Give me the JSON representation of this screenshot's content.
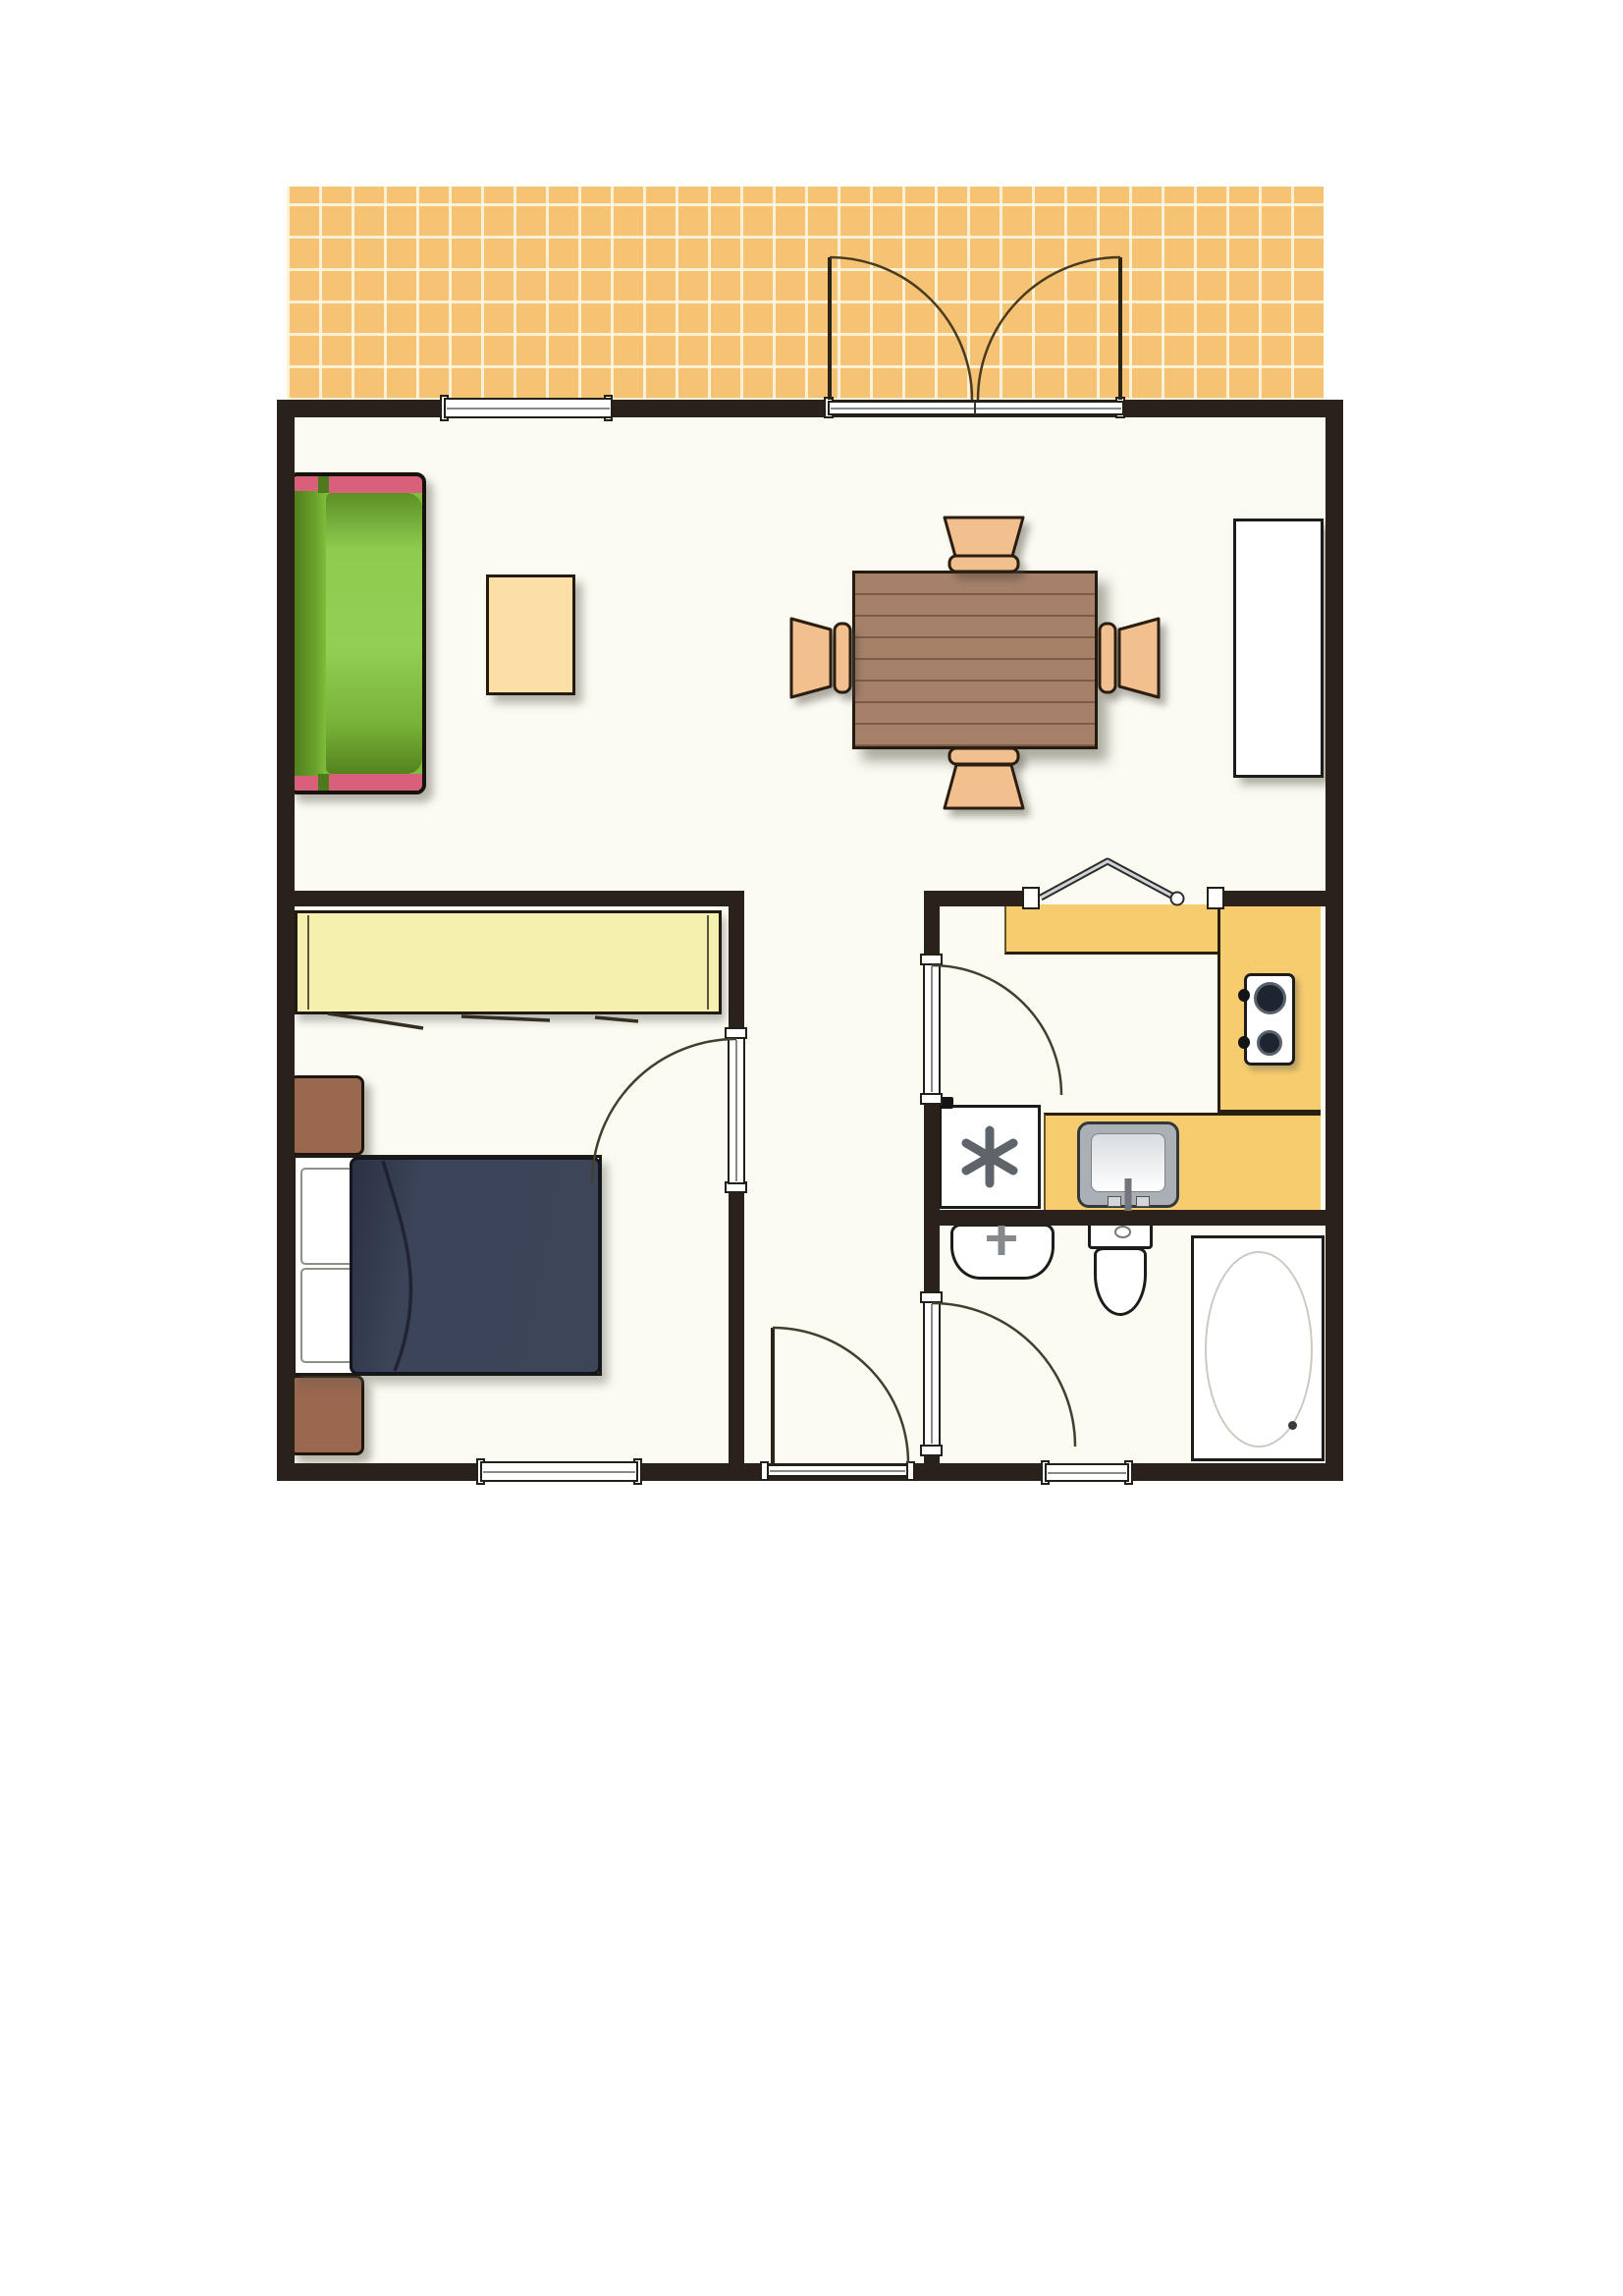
{
  "meta": {
    "title": "One-bedroom apartment floor plan",
    "type": "floor-plan",
    "visible_text": "none"
  },
  "palette": {
    "wall": "#29211a",
    "floor": "#fbfbf2",
    "outline": "#1c1c1c",
    "terrace_tile": "#f5c373",
    "terrace_grout": "#fff4dc",
    "sofa_green": "#7fbe3a",
    "sofa_green_dark": "#4e7a1d",
    "sofa_pink": "#d9607a",
    "coffee_table": "#fbdfa6",
    "dining_table": "#a7806a",
    "plank": "#8f6b55",
    "chair": "#f2c08f",
    "sideboard": "#ffffff",
    "wardrobe": "#f6f0ae",
    "nightstand": "#99684f",
    "bed_navy": "#3a4156",
    "counter": "#f6cc6e",
    "metal": "#84898e",
    "fixture_white": "#ffffff"
  },
  "rooms": [
    {
      "name": "terrace",
      "finish": "tiled"
    },
    {
      "name": "living-dining-room"
    },
    {
      "name": "bedroom"
    },
    {
      "name": "hallway"
    },
    {
      "name": "kitchen"
    },
    {
      "name": "bathroom"
    }
  ],
  "furniture": {
    "living_room": [
      "sofa",
      "coffee-table",
      "dining-table",
      "dining-chair-top",
      "dining-chair-bottom",
      "dining-chair-left",
      "dining-chair-right",
      "sideboard"
    ],
    "bedroom": [
      "wardrobe",
      "double-bed",
      "pillow-left",
      "pillow-right",
      "duvet",
      "nightstand-upper",
      "nightstand-lower"
    ],
    "kitchen": [
      "counter-top-run",
      "counter-right-run",
      "counter-sink-run",
      "cooktop-2-burner",
      "kitchen-sink",
      "washing-machine"
    ],
    "bathroom": [
      "washbasin",
      "toilet",
      "bathtub"
    ]
  },
  "openings": [
    "terrace-french-doors",
    "living-room-window",
    "bedroom-door",
    "bedroom-window",
    "kitchen-door",
    "kitchen-pass-through-folding-door",
    "bathroom-door",
    "bathroom-window",
    "entrance-door"
  ]
}
